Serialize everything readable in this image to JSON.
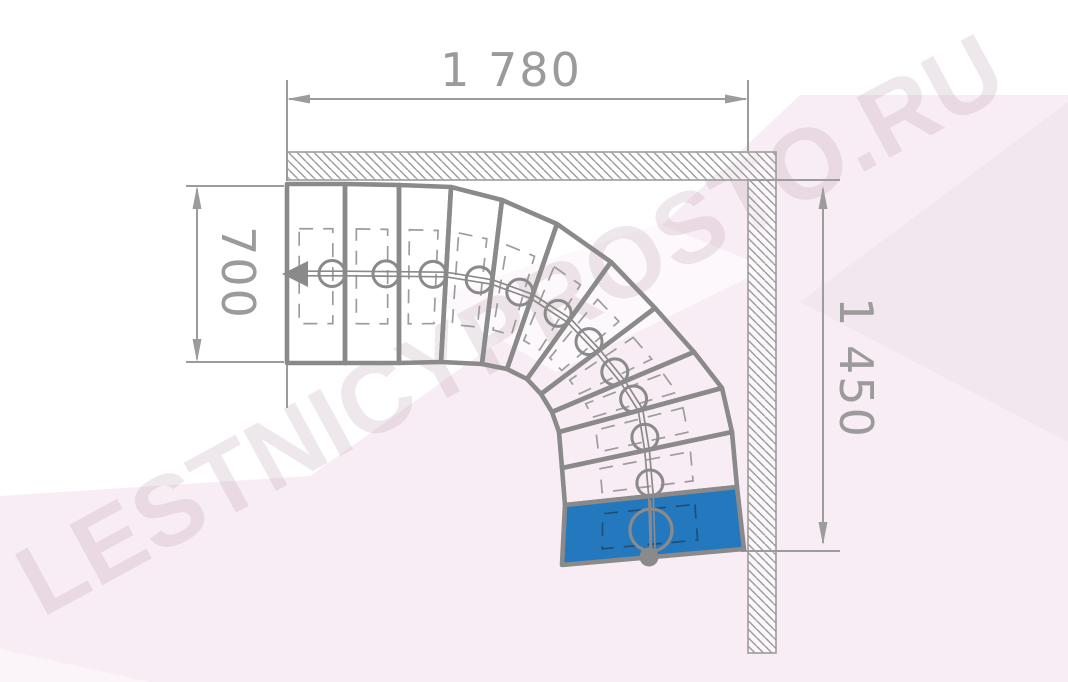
{
  "watermark": {
    "text": "LESTNICYPROSTO.RU",
    "color": "rgba(150,112,135,0.16)"
  },
  "dimensions": {
    "top": {
      "label": "1 780"
    },
    "left": {
      "label": "700"
    },
    "right": {
      "label": "1 450"
    }
  },
  "colors": {
    "heavy_line": "#8a8a8a",
    "thin_line": "#9c9c9c",
    "dim_text": "#9b9b9b",
    "first_step_blue": "#2478bd",
    "overlap_on_blue": "rgba(28,44,66,0.55)",
    "bg_pink_main": "#f8edf4",
    "bg_pink_light": "#fdf8fb",
    "bg_pink_deep": "#f3e7ef",
    "bg_pink_soft": "#fbf4f8",
    "wall_hatch": "#9c9c9c"
  },
  "stair": {
    "boundaries": [
      {
        "o": [
          287,
          184
        ],
        "i": [
          287,
          363
        ]
      },
      {
        "o": [
          345,
          184
        ],
        "i": [
          345,
          363
        ]
      },
      {
        "o": [
          399,
          185
        ],
        "i": [
          399,
          363
        ]
      },
      {
        "o": [
          451,
          187
        ],
        "i": [
          441,
          362
        ]
      },
      {
        "o": [
          502,
          200
        ],
        "i": [
          482,
          364
        ]
      },
      {
        "o": [
          557,
          224
        ],
        "i": [
          507,
          369
        ]
      },
      {
        "o": [
          611,
          262
        ],
        "i": [
          527,
          379
        ]
      },
      {
        "o": [
          655,
          308
        ],
        "i": [
          541,
          394
        ]
      },
      {
        "o": [
          694,
          352
        ],
        "i": [
          552,
          412
        ]
      },
      {
        "o": [
          722,
          388
        ],
        "i": [
          559,
          432
        ]
      },
      {
        "o": [
          732,
          432
        ],
        "i": [
          562,
          468
        ]
      },
      {
        "o": [
          737,
          487
        ],
        "i": [
          565,
          505
        ]
      },
      {
        "o": [
          744,
          549
        ],
        "i": [
          562,
          565
        ]
      }
    ],
    "first_step_index": 11,
    "overlap_inset": {
      "u": [
        0.21,
        0.79
      ],
      "v": [
        0.25,
        0.78
      ]
    },
    "marker_radius": 13,
    "start_marker": {
      "circle": [
        651,
        530,
        21
      ],
      "dot": [
        649,
        557,
        9.5
      ],
      "line": [
        650,
        500,
        651,
        560
      ]
    },
    "direction_arrow": [
      [
        282,
        274
      ],
      [
        308,
        261
      ],
      [
        308,
        287
      ]
    ]
  }
}
